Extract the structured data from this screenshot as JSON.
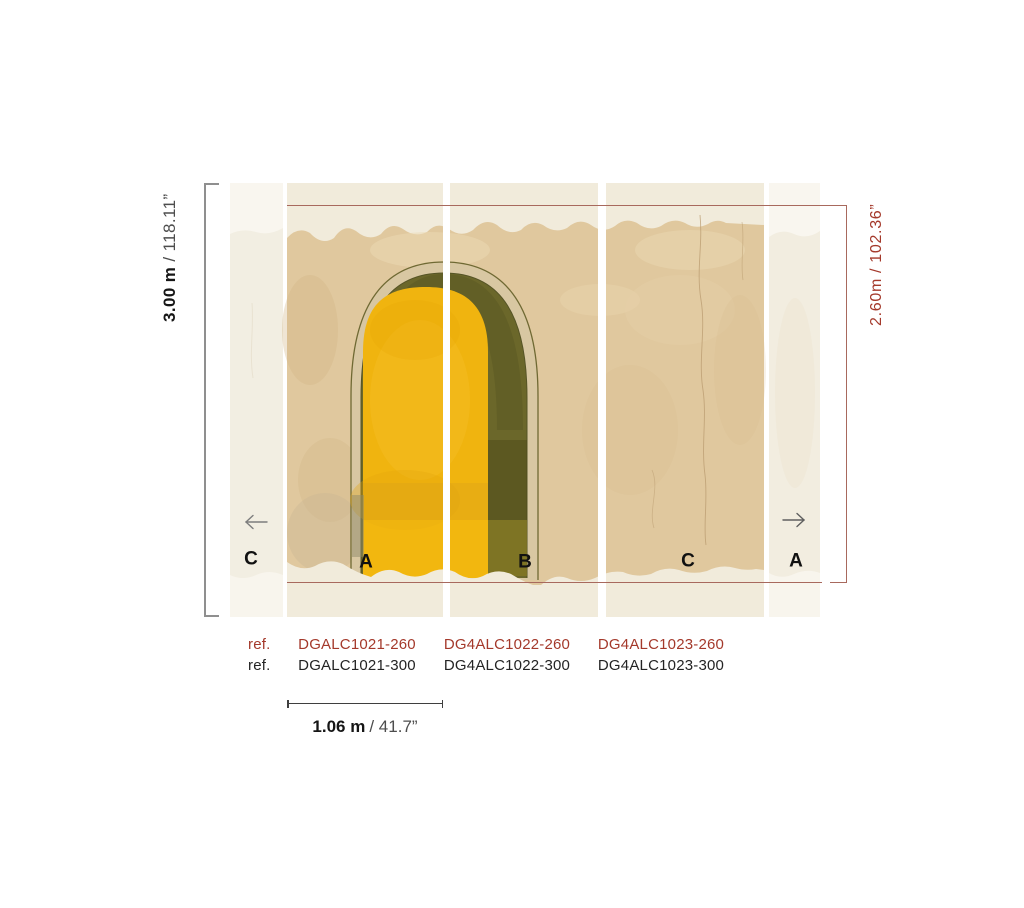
{
  "title": "Wallpaper mural panel dimension diagram",
  "palette": {
    "accent_red": "#a4392b",
    "dim_line_red": "#a8695d",
    "bracket_gray": "#8f8f8f",
    "text_black": "#161616",
    "text_gray": "#4d4d4d",
    "wall_beige": "#e0c89e",
    "arch_yellow": "#f0b40f",
    "arch_green": "#6b672a",
    "arch_frame_tan": "#d8c7a2",
    "panel_cream": "#f1ebdb",
    "strip_cream": "#f2eee2"
  },
  "dimensions": {
    "height_300": {
      "metric": "3.00 m",
      "imperial": "/ 118.11”"
    },
    "height_260": {
      "metric": "2.60m",
      "imperial": "/ 102.36”"
    },
    "width_panel": {
      "metric": "1.06 m",
      "imperial": "/ 41.7”"
    }
  },
  "panels": [
    {
      "letter": "C"
    },
    {
      "letter": "A"
    },
    {
      "letter": "B"
    },
    {
      "letter": "C"
    },
    {
      "letter": "A"
    }
  ],
  "icons": {
    "left_arrow": "arrow-left",
    "right_arrow": "arrow-right"
  },
  "references": {
    "rows": [
      {
        "label": "ref.",
        "variant": "260",
        "codes": [
          "DGALC1021-260",
          "DG4ALC1022-260",
          "DG4ALC1023-260"
        ]
      },
      {
        "label": "ref.",
        "variant": "300",
        "codes": [
          "DGALC1021-300",
          "DG4ALC1022-300",
          "DG4ALC1023-300"
        ]
      }
    ]
  }
}
